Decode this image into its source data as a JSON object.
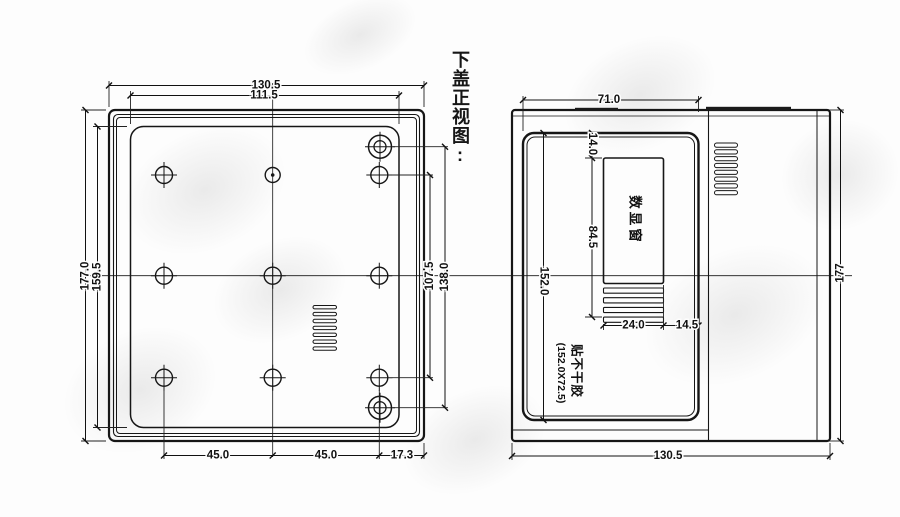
{
  "title": "下盖正视图:",
  "colors": {
    "ink": "#161616",
    "background": "#fdfdfd"
  },
  "left_view": {
    "name": "bottom cover front view",
    "dims": {
      "outer_width": "130.5",
      "inner_width": "111.5",
      "outer_height": "177.0",
      "inner_height": "159.5",
      "hole_span_vertical": "107.5",
      "corner_screw_span": "138.0",
      "hole_pitch_left": "45.0",
      "hole_pitch_right": "45.0",
      "edge_offset": "17.3"
    }
  },
  "right_view": {
    "name": "top cover view with display window",
    "dims": {
      "panel_width": "71.0",
      "panel_height": "152.0",
      "window_top_offset": "14.0",
      "window_span": "84.5",
      "window_width": "24.0",
      "window_right_gap": "14.5",
      "overall_width": "130.5",
      "overall_height": "177"
    },
    "labels": {
      "display_window": "数显窗",
      "sticker_line1": "贴不干胶",
      "sticker_line2": "(152.0X72.5)"
    }
  }
}
